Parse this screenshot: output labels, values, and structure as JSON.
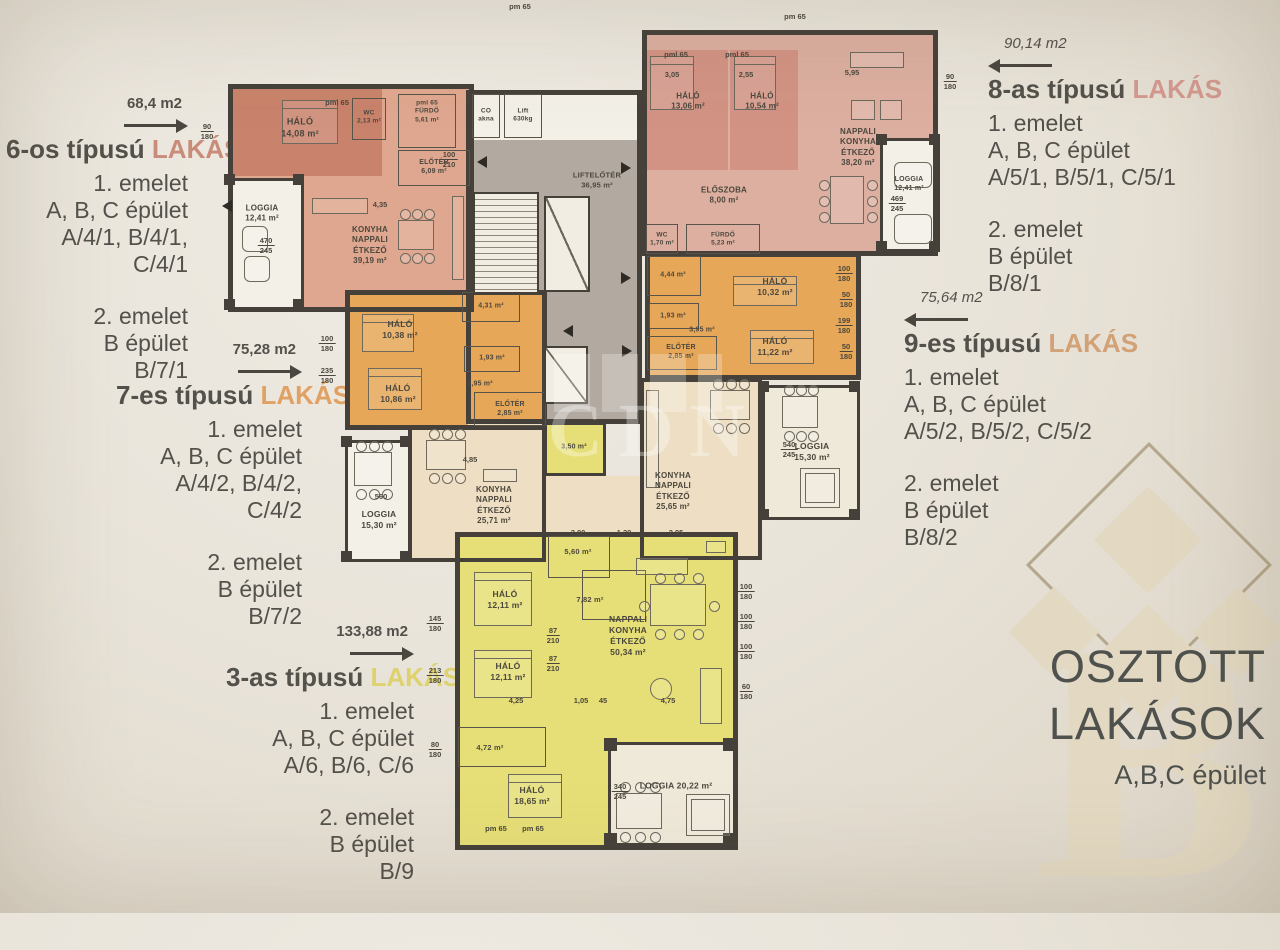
{
  "side_blocks": [
    {
      "area": "68,4 m2",
      "title": "6-os típusú",
      "accent": "LAKÁS",
      "lines1": [
        "1. emelet",
        "A, B, C épület",
        "A/4/1, B/4/1, C/4/1"
      ],
      "lines2": [
        "2. emelet",
        "B épület",
        "B/7/1"
      ]
    },
    {
      "area": "75,28 m2",
      "title": "7-es típusú",
      "accent": "LAKÁS",
      "lines1": [
        "1. emelet",
        "A, B, C épület",
        "A/4/2, B/4/2, C/4/2"
      ],
      "lines2": [
        "2. emelet",
        "B épület",
        "B/7/2"
      ]
    },
    {
      "area": "133,88 m2",
      "title": "3-as típusú",
      "accent": "LAKÁS",
      "lines1": [
        "1. emelet",
        "A, B, C épület",
        "A/6, B/6, C/6"
      ],
      "lines2": [
        "2. emelet",
        "B épület",
        "B/9"
      ]
    },
    {
      "area": "90,14 m2",
      "title": "8-as típusú",
      "accent": "LAKÁS",
      "lines1": [
        "1. emelet",
        "A, B, C épület",
        "A/5/1, B/5/1, C/5/1"
      ],
      "lines2": [
        "2. emelet",
        "B épület",
        "B/8/1"
      ]
    },
    {
      "area": "75,64 m2",
      "title": "9-es típusú",
      "accent": "LAKÁS",
      "lines1": [
        "1. emelet",
        "A, B, C épület",
        "A/5/2, B/5/2, C/5/2"
      ],
      "lines2": [
        "2. emelet",
        "B épület",
        "B/8/2"
      ]
    }
  ],
  "footer": {
    "line1": "OSZTOTT",
    "line2": "LAKÁSOK",
    "line3": "A,B,C épület"
  },
  "watermark": "CDN",
  "palette": {
    "salmon": "#dfa78f",
    "salmon_dark": "#c9836c",
    "pink": "#dcafa0",
    "pink_dark": "#d29384",
    "orange": "#e6a759",
    "cream": "#eedfc4",
    "yellow": "#e6df77",
    "gray": "#b2aaa0",
    "white": "#f3f0e8",
    "cream_white": "#efe9da",
    "wall": "#45413a"
  },
  "plan": {
    "fills": [
      [
        228,
        84,
        246,
        228,
        "salmon"
      ],
      [
        232,
        88,
        150,
        88,
        "salmon_dark"
      ],
      [
        230,
        178,
        72,
        132,
        "white"
      ],
      [
        642,
        30,
        296,
        226,
        "pink"
      ],
      [
        646,
        50,
        82,
        120,
        "pink_dark"
      ],
      [
        730,
        50,
        68,
        120,
        "pink_dark"
      ],
      [
        882,
        140,
        56,
        110,
        "white"
      ],
      [
        468,
        92,
        172,
        48,
        "white"
      ],
      [
        468,
        140,
        172,
        282,
        "gray"
      ],
      [
        347,
        292,
        198,
        136,
        "orange"
      ],
      [
        410,
        427,
        134,
        133,
        "cream"
      ],
      [
        347,
        442,
        62,
        118,
        "white"
      ],
      [
        468,
        424,
        76,
        116,
        "cream"
      ],
      [
        546,
        424,
        58,
        50,
        "yellow"
      ],
      [
        546,
        476,
        94,
        58,
        "cream"
      ],
      [
        647,
        254,
        212,
        124,
        "orange"
      ],
      [
        642,
        380,
        118,
        178,
        "cream"
      ],
      [
        764,
        387,
        94,
        131,
        "cream_white"
      ],
      [
        457,
        534,
        279,
        314,
        "yellow"
      ],
      [
        610,
        744,
        126,
        100,
        "cream_white"
      ]
    ],
    "walls": [
      [
        228,
        84,
        246,
        228,
        5
      ],
      [
        228,
        178,
        76,
        132,
        3
      ],
      [
        642,
        30,
        296,
        226,
        5
      ],
      [
        880,
        138,
        60,
        114,
        3
      ],
      [
        466,
        90,
        176,
        334,
        5
      ],
      [
        345,
        290,
        202,
        140,
        5
      ],
      [
        408,
        425,
        138,
        137,
        4
      ],
      [
        345,
        440,
        66,
        122,
        3
      ],
      [
        645,
        252,
        216,
        128,
        5
      ],
      [
        640,
        378,
        122,
        182,
        4
      ],
      [
        762,
        385,
        98,
        135,
        3
      ],
      [
        455,
        532,
        283,
        318,
        5
      ],
      [
        608,
        742,
        130,
        104,
        3
      ],
      [
        544,
        422,
        62,
        54,
        3
      ]
    ],
    "boxes": [
      [
        352,
        98,
        34,
        42
      ],
      [
        398,
        94,
        58,
        54
      ],
      [
        398,
        150,
        72,
        36
      ],
      [
        472,
        94,
        28,
        44
      ],
      [
        504,
        94,
        38,
        44
      ],
      [
        646,
        224,
        32,
        30
      ],
      [
        686,
        224,
        74,
        30
      ],
      [
        462,
        292,
        58,
        30
      ],
      [
        464,
        346,
        56,
        26
      ],
      [
        474,
        392,
        72,
        34
      ],
      [
        647,
        256,
        54,
        40
      ],
      [
        649,
        303,
        50,
        26
      ],
      [
        647,
        336,
        70,
        34
      ],
      [
        548,
        536,
        62,
        42
      ],
      [
        582,
        570,
        64,
        50
      ],
      [
        458,
        727,
        88,
        40
      ]
    ],
    "labels": [
      [
        300,
        128,
        [
          "HÁLÓ",
          "14,08 m²"
        ],
        9
      ],
      [
        262,
        214,
        [
          "LOGGIA",
          "12,41 m²"
        ],
        8
      ],
      [
        370,
        246,
        [
          "KONYHA",
          "NAPPALI",
          "ÉTKEZŐ",
          "39,19 m²"
        ],
        8
      ],
      [
        369,
        118,
        [
          "WC",
          "2,13 m²"
        ],
        6.5
      ],
      [
        427,
        112,
        [
          "pml 65",
          "FÜRDŐ",
          "5,61 m²"
        ],
        6.5
      ],
      [
        434,
        167,
        [
          "ELŐTÉR",
          "6,09 m²"
        ],
        7
      ],
      [
        486,
        116,
        [
          "CO",
          "akna"
        ],
        6.5
      ],
      [
        523,
        116,
        [
          "Lift",
          "630kg"
        ],
        6.5
      ],
      [
        597,
        180,
        [
          "LIFTELŐTÉR",
          "36,95 m²"
        ],
        7.5
      ],
      [
        688,
        102,
        [
          "HÁLÓ",
          "13,06 m²"
        ],
        8
      ],
      [
        762,
        102,
        [
          "HÁLÓ",
          "10,54 m²"
        ],
        8
      ],
      [
        858,
        148,
        [
          "NAPPALI",
          "KONYHA",
          "ÉTKEZŐ",
          "38,20 m²"
        ],
        8
      ],
      [
        724,
        196,
        [
          "ELŐSZOBA",
          "8,00 m²"
        ],
        8
      ],
      [
        662,
        240,
        [
          "WC",
          "1,70 m²"
        ],
        6.5
      ],
      [
        723,
        240,
        [
          "FÜRDŐ",
          "5,23 m²"
        ],
        6.5
      ],
      [
        909,
        184,
        [
          "LOGGIA",
          "12,41 m²"
        ],
        7
      ],
      [
        400,
        330,
        [
          "HÁLÓ",
          "10,38 m²"
        ],
        8.5
      ],
      [
        398,
        394,
        [
          "HÁLÓ",
          "10,86 m²"
        ],
        8.5
      ],
      [
        491,
        306,
        [
          "4,31 m²"
        ],
        7
      ],
      [
        492,
        358,
        [
          "1,93 m²"
        ],
        7
      ],
      [
        480,
        384,
        [
          "3,95 m²"
        ],
        7
      ],
      [
        510,
        409,
        [
          "ELŐTÉR",
          "2,85 m²"
        ],
        7
      ],
      [
        494,
        506,
        [
          "KONYHA",
          "NAPPALI",
          "ÉTKEZŐ",
          "25,71 m²"
        ],
        8
      ],
      [
        379,
        520,
        [
          "LOGGIA",
          "15,30 m²"
        ],
        8.5
      ],
      [
        673,
        275,
        [
          "4,44 m²"
        ],
        7
      ],
      [
        775,
        287,
        [
          "HÁLÓ",
          "10,32 m²"
        ],
        8.5
      ],
      [
        673,
        316,
        [
          "1,93 m²"
        ],
        7
      ],
      [
        702,
        330,
        [
          "3,95 m²"
        ],
        7
      ],
      [
        681,
        352,
        [
          "ELŐTÉR",
          "2,85 m²"
        ],
        7
      ],
      [
        775,
        347,
        [
          "HÁLÓ",
          "11,22 m²"
        ],
        8.5
      ],
      [
        673,
        492,
        [
          "KONYHA",
          "NAPPALI",
          "ÉTKEZŐ",
          "25,65 m²"
        ],
        8
      ],
      [
        812,
        452,
        [
          "LOGGIA",
          "15,30 m²"
        ],
        8.5
      ],
      [
        574,
        447,
        [
          "3,50 m²"
        ],
        7
      ],
      [
        578,
        552,
        [
          "5,60 m²"
        ],
        7.5
      ],
      [
        590,
        600,
        [
          "7,82 m²"
        ],
        7.5
      ],
      [
        505,
        600,
        [
          "HÁLÓ",
          "12,11 m²"
        ],
        8.5
      ],
      [
        508,
        672,
        [
          "HÁLÓ",
          "12,11 m²"
        ],
        8.5
      ],
      [
        628,
        636,
        [
          "NAPPALI",
          "KONYHA",
          "ÉTKEZŐ",
          "50,34 m²"
        ],
        8.5
      ],
      [
        490,
        748,
        [
          "4,72 m²"
        ],
        7.5
      ],
      [
        532,
        796,
        [
          "HÁLÓ",
          "18,65 m²"
        ],
        8.5
      ],
      [
        676,
        786,
        [
          "LOGGIA   20,22 m²"
        ],
        8.5
      ]
    ],
    "dims": [
      [
        207,
        122,
        "90",
        "180"
      ],
      [
        266,
        236,
        "470",
        "245"
      ],
      [
        449,
        150,
        "100",
        "210"
      ],
      [
        520,
        2,
        "pm 65"
      ],
      [
        795,
        12,
        "pm 65"
      ],
      [
        676,
        50,
        "pml 65"
      ],
      [
        737,
        50,
        "pml 65"
      ],
      [
        337,
        98,
        "pml 65"
      ],
      [
        950,
        72,
        "90",
        "180"
      ],
      [
        897,
        194,
        "469",
        "245"
      ],
      [
        844,
        264,
        "100",
        "180"
      ],
      [
        846,
        290,
        "50",
        "180"
      ],
      [
        844,
        316,
        "199",
        "180"
      ],
      [
        846,
        342,
        "50",
        "180"
      ],
      [
        327,
        334,
        "100",
        "180"
      ],
      [
        327,
        366,
        "235",
        "180"
      ],
      [
        381,
        492,
        "560"
      ],
      [
        789,
        440,
        "540",
        "245"
      ],
      [
        435,
        614,
        "145",
        "180"
      ],
      [
        435,
        666,
        "213",
        "180"
      ],
      [
        435,
        740,
        "80",
        "180"
      ],
      [
        620,
        782,
        "340",
        "245"
      ],
      [
        746,
        582,
        "100",
        "180"
      ],
      [
        746,
        612,
        "100",
        "180"
      ],
      [
        746,
        642,
        "100",
        "180"
      ],
      [
        746,
        682,
        "60",
        "180"
      ],
      [
        578,
        528,
        "2,00"
      ],
      [
        624,
        528,
        "1,20"
      ],
      [
        676,
        528,
        "2,95"
      ],
      [
        516,
        696,
        "4,25"
      ],
      [
        581,
        696,
        "1,05"
      ],
      [
        603,
        696,
        "45"
      ],
      [
        668,
        696,
        "4,75"
      ],
      [
        553,
        626,
        "87",
        "210"
      ],
      [
        553,
        654,
        "87",
        "210"
      ],
      [
        380,
        200,
        "4,35"
      ],
      [
        470,
        455,
        "4,85"
      ],
      [
        672,
        70,
        "3,05"
      ],
      [
        746,
        70,
        "2,55"
      ],
      [
        852,
        68,
        "5,95"
      ],
      [
        496,
        824,
        "pm 65"
      ],
      [
        533,
        824,
        "pm 65"
      ]
    ],
    "markers": [
      [
        222,
        200,
        "l"
      ],
      [
        477,
        156,
        "l"
      ],
      [
        621,
        162,
        "r"
      ],
      [
        621,
        272,
        "r"
      ],
      [
        563,
        325,
        "l"
      ],
      [
        622,
        345,
        "r"
      ]
    ],
    "furniture": [
      [
        "bed",
        282,
        100,
        56,
        44
      ],
      [
        "bed",
        650,
        56,
        44,
        54
      ],
      [
        "bed",
        734,
        56,
        42,
        54
      ],
      [
        "bed",
        362,
        314,
        52,
        38
      ],
      [
        "bed",
        368,
        368,
        54,
        42
      ],
      [
        "bed",
        733,
        276,
        64,
        30
      ],
      [
        "bed",
        750,
        330,
        64,
        34
      ],
      [
        "bed",
        474,
        572,
        58,
        54
      ],
      [
        "bed",
        474,
        650,
        58,
        48
      ],
      [
        "bed",
        508,
        774,
        54,
        44
      ],
      [
        "table6",
        398,
        220,
        36,
        30
      ],
      [
        "table6",
        830,
        176,
        34,
        48
      ],
      [
        "table6",
        426,
        440,
        40,
        30
      ],
      [
        "table6",
        354,
        452,
        38,
        34
      ],
      [
        "table6",
        710,
        390,
        40,
        30
      ],
      [
        "table6",
        782,
        396,
        36,
        32
      ],
      [
        "table6",
        616,
        793,
        46,
        36
      ],
      [
        "table8",
        650,
        584,
        56,
        42
      ],
      [
        "tub",
        686,
        794,
        44,
        42
      ],
      [
        "tub",
        800,
        468,
        40,
        40
      ],
      [
        "round",
        242,
        226,
        26,
        26
      ],
      [
        "round",
        244,
        256,
        26,
        26
      ],
      [
        "round",
        894,
        162,
        38,
        26
      ],
      [
        "round",
        894,
        214,
        38,
        30
      ],
      [
        "rect",
        312,
        198,
        56,
        16
      ],
      [
        "rect",
        452,
        196,
        12,
        84
      ],
      [
        "rect",
        850,
        52,
        54,
        16
      ],
      [
        "rect",
        851,
        100,
        24,
        20
      ],
      [
        "rect",
        880,
        100,
        22,
        20
      ],
      [
        "rect",
        483,
        469,
        34,
        13
      ],
      [
        "rect",
        646,
        390,
        13,
        98
      ],
      [
        "rect",
        636,
        558,
        52,
        17
      ],
      [
        "rect",
        700,
        668,
        22,
        56
      ],
      [
        "rect",
        706,
        541,
        20,
        12
      ],
      [
        "circle",
        650,
        678,
        22,
        22
      ]
    ],
    "blocks": [
      [
        604,
        738,
        13,
        13
      ],
      [
        723,
        738,
        13,
        13
      ],
      [
        604,
        833,
        13,
        13
      ],
      [
        723,
        833,
        13,
        13
      ],
      [
        758,
        381,
        11,
        11
      ],
      [
        849,
        381,
        11,
        11
      ],
      [
        758,
        509,
        11,
        11
      ],
      [
        849,
        509,
        11,
        11
      ],
      [
        341,
        436,
        11,
        11
      ],
      [
        400,
        436,
        11,
        11
      ],
      [
        341,
        551,
        11,
        11
      ],
      [
        400,
        551,
        11,
        11
      ],
      [
        224,
        174,
        11,
        11
      ],
      [
        293,
        174,
        11,
        11
      ],
      [
        224,
        299,
        11,
        11
      ],
      [
        293,
        299,
        11,
        11
      ],
      [
        876,
        134,
        11,
        11
      ],
      [
        929,
        134,
        11,
        11
      ],
      [
        876,
        241,
        11,
        11
      ],
      [
        929,
        241,
        11,
        11
      ]
    ],
    "stair": [
      473,
      192,
      66,
      102
    ],
    "shafts": [
      [
        544,
        196,
        46,
        96
      ],
      [
        544,
        346,
        44,
        58
      ]
    ]
  }
}
